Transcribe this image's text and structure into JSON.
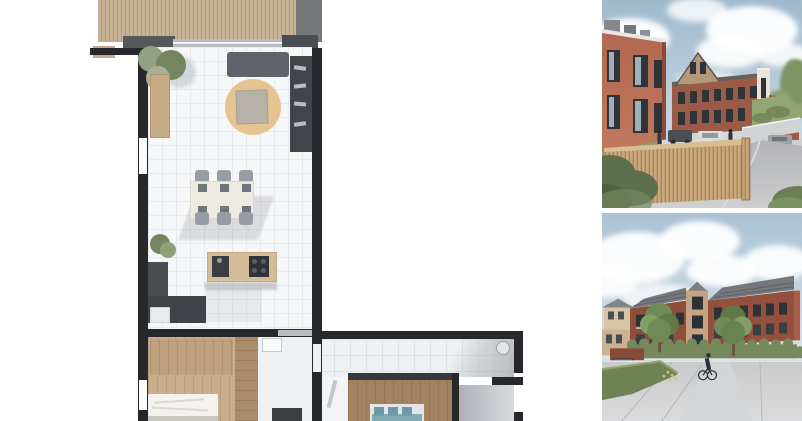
{
  "page": {
    "title": "Property media montage",
    "background": "#ffffff"
  },
  "floorplan": {
    "label": "Apartment floor plan (top view)",
    "alt": "L-shaped apartment floor plan with timber terrace, living room with sofa and rug, dining table with six chairs, kitchen island, two bedrooms, hallway and bathroom",
    "palette": {
      "wall": "#27282b",
      "deck": "#c8b295",
      "deck_stripe": "#b29c7f",
      "floor": "#f6f7f9",
      "grid": "#e8eaee",
      "wood": "#c9ae8c",
      "wood_mid": "#ab8c68",
      "wood_dark": "#a3835f",
      "rug": "#e5c48f",
      "sofa": "#5f646c",
      "shelf": "#41444b",
      "counter": "#3f4247",
      "island": "#d3bc97",
      "table": "#edeae0",
      "chair": "#989ca3",
      "teal": "#699aa6",
      "plant": "#75855f",
      "bed": "#f3f2ef"
    }
  },
  "photo_top": {
    "label": "Exterior render - street view",
    "alt": "Render of red brick apartment buildings with gabled block, timber slat fence, parked cars and sloping access road",
    "palette": {
      "sky_top": "#9fbacd",
      "sky_bottom": "#cfdde7",
      "brick": "#b26750",
      "brick_dark": "#9c5b46",
      "gable": "#b5977a",
      "window": "#2f3439",
      "glass": "#9fb0bb",
      "fence": "#c9a87b",
      "fence_dark": "#a8875a",
      "fence_rail": "#d9bd93",
      "road": "#b3b4b6",
      "pavement": "#d6d7d8",
      "grass": "#8d9f6a",
      "bush": "#5d6f4b",
      "tower": "#eae4d8"
    }
  },
  "photo_bottom": {
    "label": "Exterior render - courtyard view",
    "alt": "Render of brick apartment block with tan stair tower, hedges, two trees, a cyclist and a paved parking area",
    "palette": {
      "sky_top": "#a9c2d4",
      "sky_bottom": "#dce5eb",
      "brick_left": "#8f4d3b",
      "brick_right": "#93503d",
      "tower": "#c4a485",
      "roof": "#74787d",
      "window": "#2e3237",
      "hedge": "#76895c",
      "hedge_bright": "#6e8254",
      "lot": "#c9cacb",
      "tree": "#6f8a55",
      "house": "#d9c4a4",
      "flower": "#d9c96a"
    }
  }
}
